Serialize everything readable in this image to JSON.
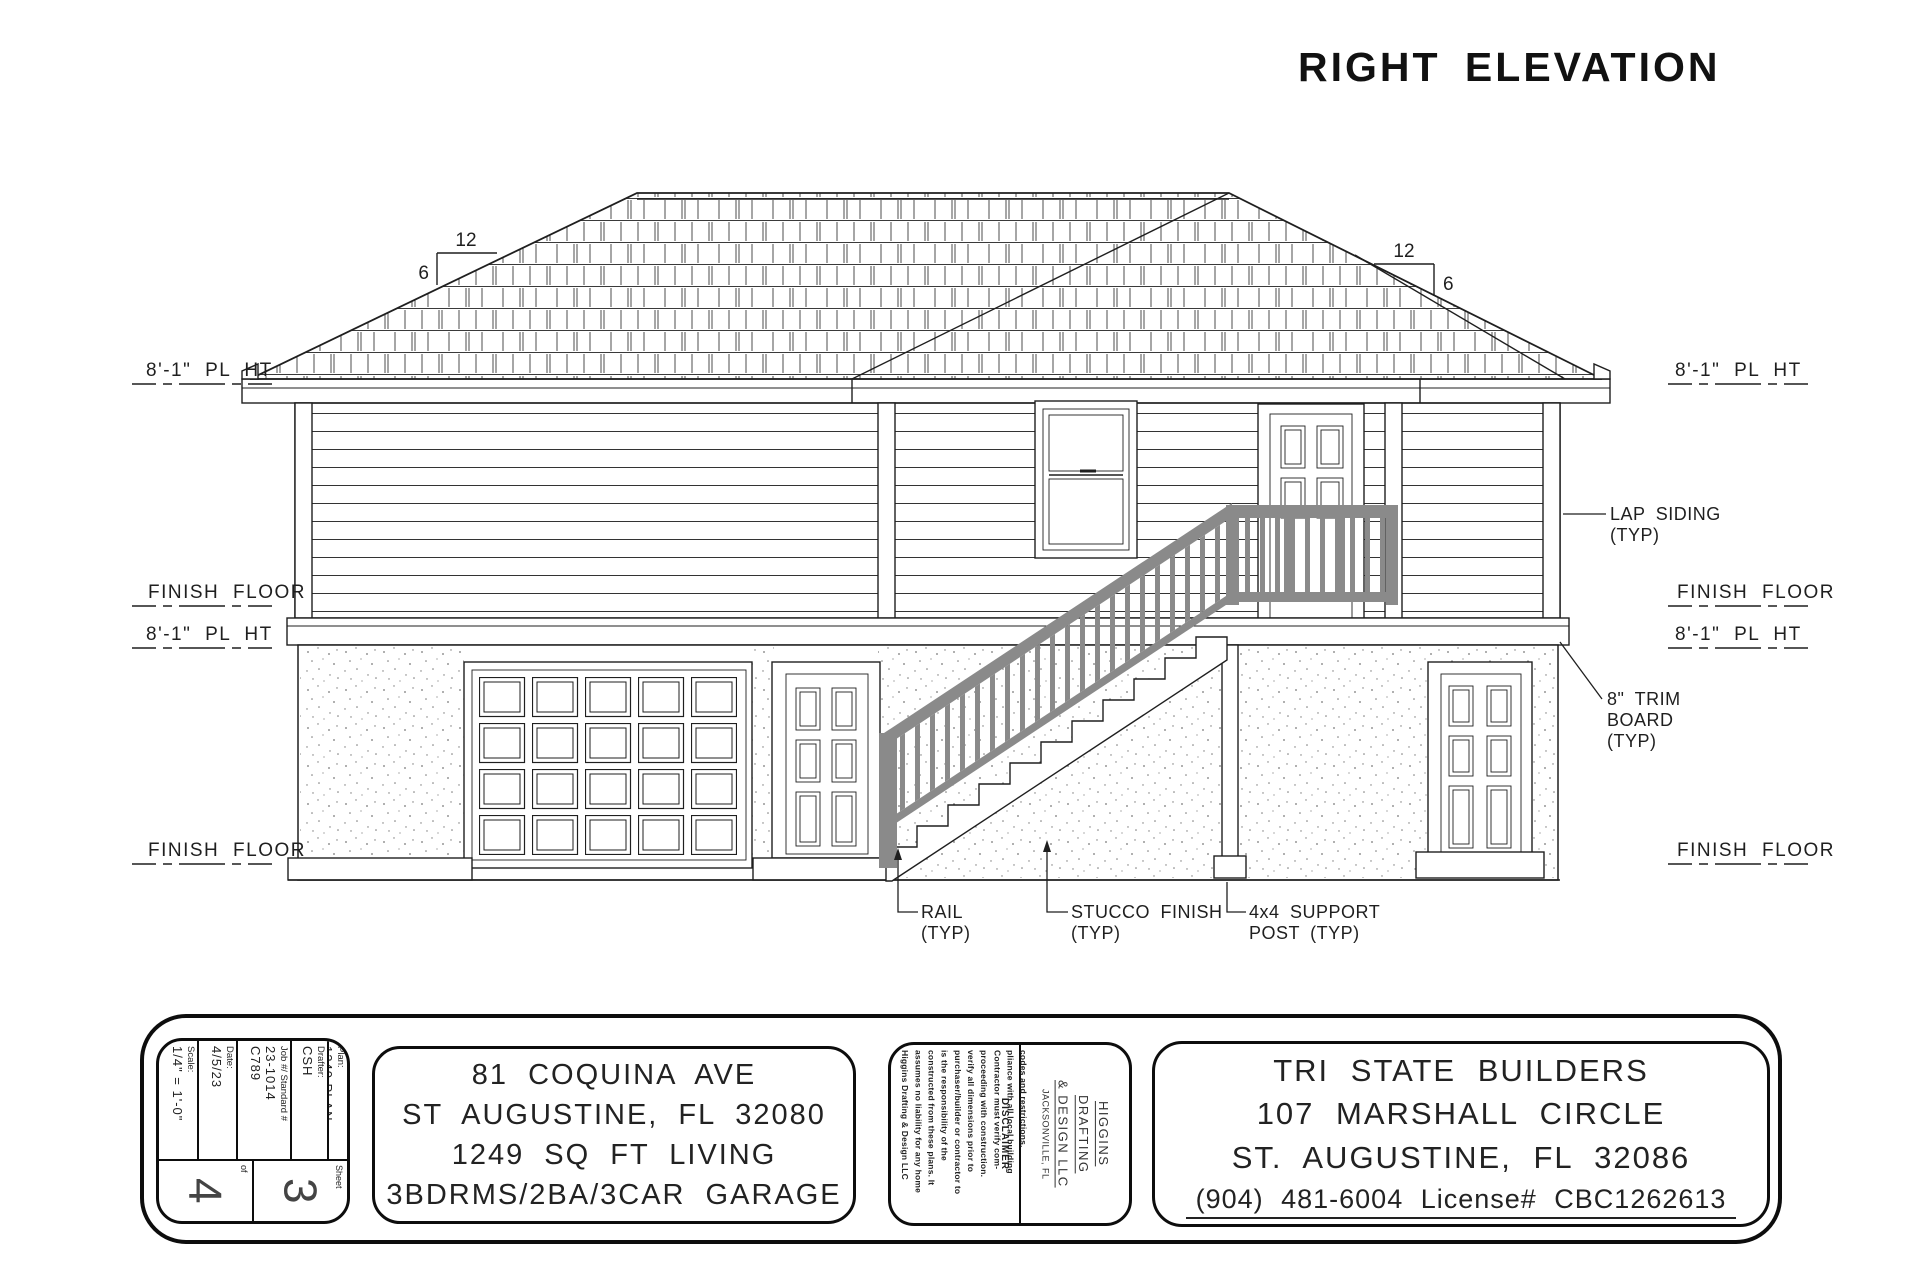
{
  "title": "RIGHT ELEVATION",
  "pitch": {
    "run": "12",
    "rise": "6"
  },
  "levels": {
    "pl_ht": "8'-1\" PL HT",
    "finish_floor": "FINISH FLOOR"
  },
  "annotations": {
    "lap_siding": [
      "LAP SIDING",
      "(TYP)"
    ],
    "trim_board": [
      "8\" TRIM",
      "BOARD",
      "(TYP)"
    ],
    "rail": [
      "RAIL",
      "(TYP)"
    ],
    "stucco": [
      "STUCCO FINISH",
      "(TYP)"
    ],
    "support_post": [
      "4x4 SUPPORT",
      "POST (TYP)"
    ]
  },
  "titleblock": {
    "scale_label": "Scale:",
    "scale_value": "1/4\" = 1'-0\"",
    "date_label": "Date:",
    "date_value": "4/5/23",
    "job_label": "Job #/ Standard #",
    "job_value1": "23-1014",
    "job_value2": "C789",
    "drafter_label": "Drafter:",
    "drafter_value": "CSH",
    "plan_label": "Plan:",
    "plan_value": "1249 PLAN",
    "of_label": "of",
    "of_total": "4",
    "sheet_label": "Sheet",
    "sheet_number": "3",
    "address": [
      "81 COQUINA AVE",
      "ST AUGUSTINE, FL 32080",
      "1249 SQ FT LIVING",
      "3BDRMS/2BA/3CAR GARAGE"
    ],
    "disclaimer_title": "DISCLAIMER",
    "disclaimer_lines": [
      "Higgins Drafting & Design LLC",
      "assumes no liability for any home",
      "constructed from these plans. It",
      "is the responsibility of the",
      "purchaser/builder or contractor to",
      "verify all dimensions prior to",
      "proceeding with construction.",
      "Contractor must verify com-",
      "pliance with all local building",
      "codes and restrictions."
    ],
    "firm": [
      "HIGGINS",
      "DRAFTING",
      "& DESIGN LLC"
    ],
    "firm_city": "JACKSONVILLE, FL",
    "builder": [
      "TRI STATE BUILDERS",
      "107 MARSHALL CIRCLE",
      "ST. AUGUSTINE, FL 32086"
    ],
    "builder_contact": "(904) 481-6004  License# CBC1262613"
  },
  "colors": {
    "ink": "#1f1f1f",
    "rail": "#8a8a8a"
  }
}
